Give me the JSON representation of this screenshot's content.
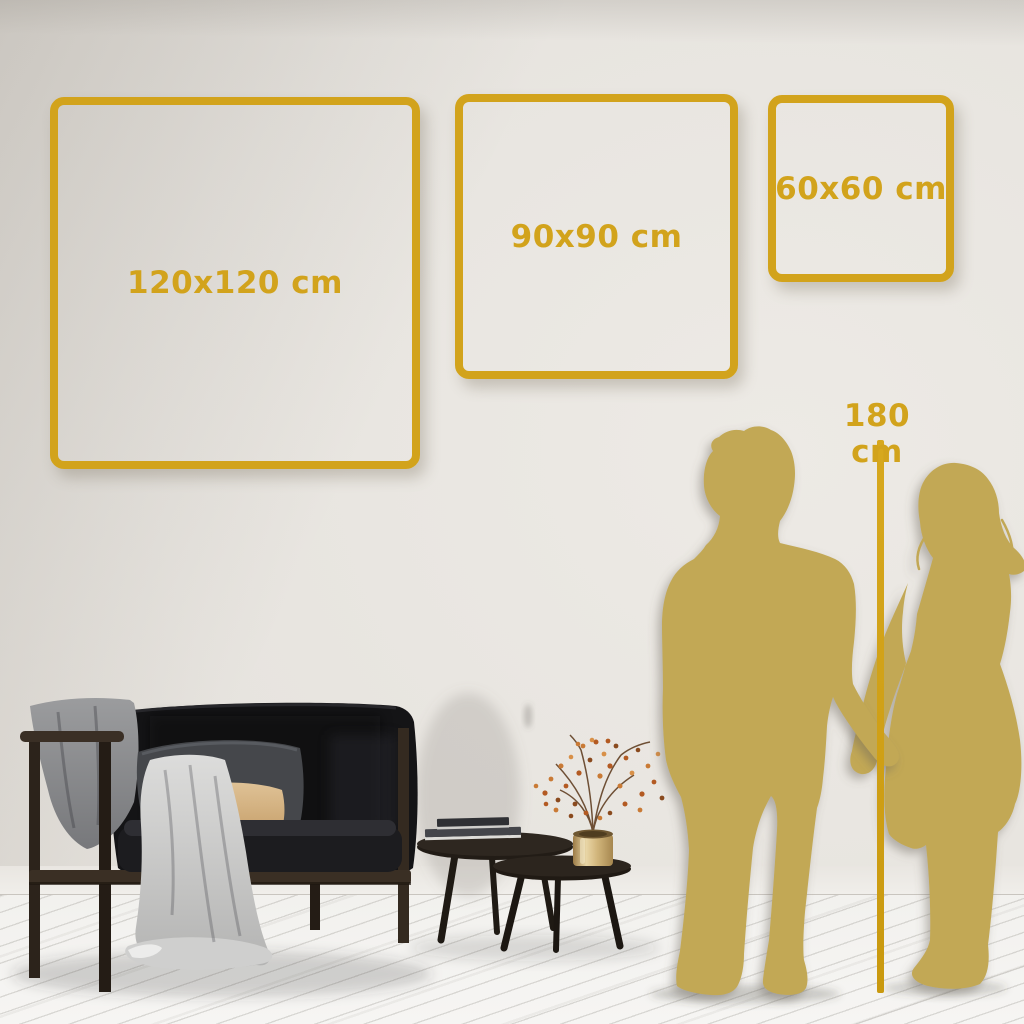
{
  "theme": {
    "accent_gold": "#D2A31C",
    "ruler_gold": "#C9990F",
    "silhouette_gold": "#C2A855",
    "wall_light": "#EDEAE5",
    "wall_dark": "#D2CEC8",
    "floor_light": "#F4F3F1"
  },
  "size_frames": [
    {
      "label": "120x120 cm",
      "width_cm": 120,
      "height_cm": 120
    },
    {
      "label": "90x90 cm",
      "width_cm": 90,
      "height_cm": 90
    },
    {
      "label": "60x60 cm",
      "width_cm": 60,
      "height_cm": 60
    }
  ],
  "height_reference": {
    "label": "180 cm",
    "value_cm": 180
  }
}
